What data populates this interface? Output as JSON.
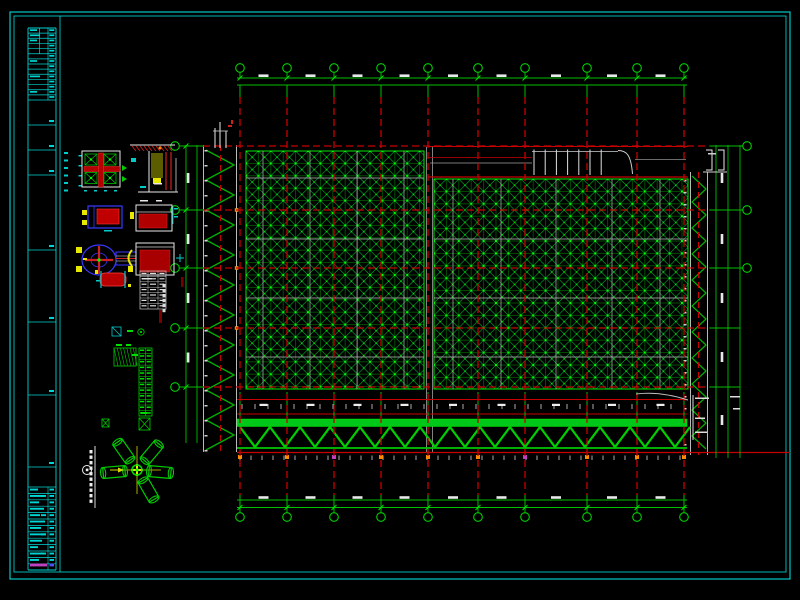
{
  "window": {
    "type": "cad-drawing-sheet-viewer",
    "background": "#000000"
  },
  "colors": {
    "border_cyan": "#00c8c8",
    "axis_red": "#c80000",
    "structure_green": "#00c800",
    "bright_green": "#00ff00",
    "grid_green": "#008c00",
    "diag_green": "#00c832",
    "white_lines": "#e0e0e0",
    "gray_chords": "#bdbdbd",
    "detail_red": "#b40000",
    "detail_blue": "#3838ff",
    "detail_yellow": "#e8e800",
    "detail_cyan": "#00cccc",
    "magenta_accent": "#c040c0",
    "orange_node": "#ff8c00"
  },
  "axes": {
    "top_bubbles": {
      "count": 10,
      "x": [
        240,
        287,
        334,
        381,
        428,
        478,
        525,
        587,
        637,
        684
      ],
      "y": 68
    },
    "bottom_bubbles": {
      "count": 10,
      "x": [
        240,
        287,
        334,
        381,
        428,
        478,
        525,
        587,
        637,
        684
      ],
      "y": 517
    },
    "left_bubbles": {
      "count": 5,
      "x": 175,
      "y": [
        146,
        210,
        268,
        328,
        387
      ]
    },
    "right_bubbles": {
      "count": 3,
      "x": 747,
      "y": [
        146,
        210,
        268
      ]
    },
    "bubble_radius": 4.3,
    "labels_legible": false
  },
  "plan": {
    "left_panel": {
      "x": 246,
      "y": 151,
      "w": 178,
      "h": 238,
      "cell": 12.4,
      "type": "space-frame-grid"
    },
    "right_panel": {
      "x": 434,
      "y": 179,
      "w": 254,
      "h": 210,
      "cell": 12.4,
      "type": "space-frame-grid"
    },
    "expansion_joint_x": [
      426.5,
      432.5
    ],
    "edge_truss_left": {
      "x1": 203.5,
      "x2": 236.5,
      "y1": 145,
      "y2": 452
    },
    "edge_truss_right": {
      "x1": 690.5,
      "x2": 707.5,
      "y1": 172,
      "y2": 455
    },
    "roof_strip": {
      "x1": 428,
      "x2": 688,
      "y1": 146.5,
      "y2": 177
    },
    "perimeter_truss": {
      "x1": 237,
      "x2": 687,
      "chord_y": 419,
      "web_top": 427,
      "web_bottom": 447,
      "bottom_y": 448,
      "period": 30
    }
  },
  "dimensions": {
    "top_lines_y": [
      78,
      85
    ],
    "bottom_lines_y": [
      500,
      507.5
    ],
    "left_lines_x": [
      186,
      197
    ],
    "right_lines_x": [
      716,
      728,
      740
    ],
    "text_legible": false
  },
  "title_block": {
    "strip": {
      "x1": 28,
      "x2": 56,
      "y1": 28,
      "y2": 570
    },
    "header_rows": 14,
    "cell_dividers_y": [
      125,
      150,
      175,
      250,
      322,
      395,
      467
    ],
    "bottom_start_y": 487,
    "bottom_rows": 13,
    "text_legible": false
  },
  "details": [
    {
      "name": "bearing-plan-detail"
    },
    {
      "name": "embed-section-detail"
    },
    {
      "name": "bearing-side-elevation-blue"
    },
    {
      "name": "bearing-elevation-white-red"
    },
    {
      "name": "bearing-flange-view"
    },
    {
      "name": "bearing-section-red"
    },
    {
      "name": "pipe-sleeve-detail"
    },
    {
      "name": "mini-schedule-table"
    },
    {
      "name": "member-schedule-table"
    },
    {
      "name": "gusset-hatch-detail"
    },
    {
      "name": "ball-node-fan-detail"
    },
    {
      "name": "detail-callout-1"
    }
  ]
}
